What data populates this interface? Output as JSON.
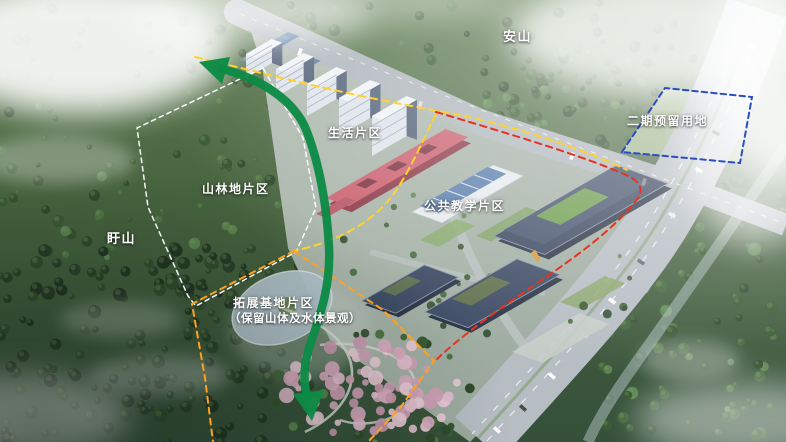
{
  "scene": {
    "description": "aerial-campus-masterplan-rendering"
  },
  "labels": {
    "anshan": "安山",
    "xushan": "盱山",
    "phase2_reserved": "二期预留用地",
    "living_zone": "生活片区",
    "forest_zone": "山林地片区",
    "teaching_zone": "公共教学片区",
    "expansion_zone": "拓展基地片区",
    "expansion_note": "（保留山体及水体景观）"
  },
  "boundaries": [
    {
      "name": "site-red-line",
      "color": "#e63420",
      "style": "dashed"
    },
    {
      "name": "campus-yellow-line",
      "color": "#ffd22e",
      "style": "dashed"
    },
    {
      "name": "expansion-orange-line",
      "color": "#ffa01e",
      "style": "dashed"
    },
    {
      "name": "forest-white-line",
      "color": "#ffffff",
      "style": "dashed"
    },
    {
      "name": "phase2-blue-line",
      "color": "#2b4ec4",
      "style": "dashed"
    }
  ],
  "axis_arrow": {
    "name": "green-landscape-axis",
    "color": "#0c8a45"
  }
}
